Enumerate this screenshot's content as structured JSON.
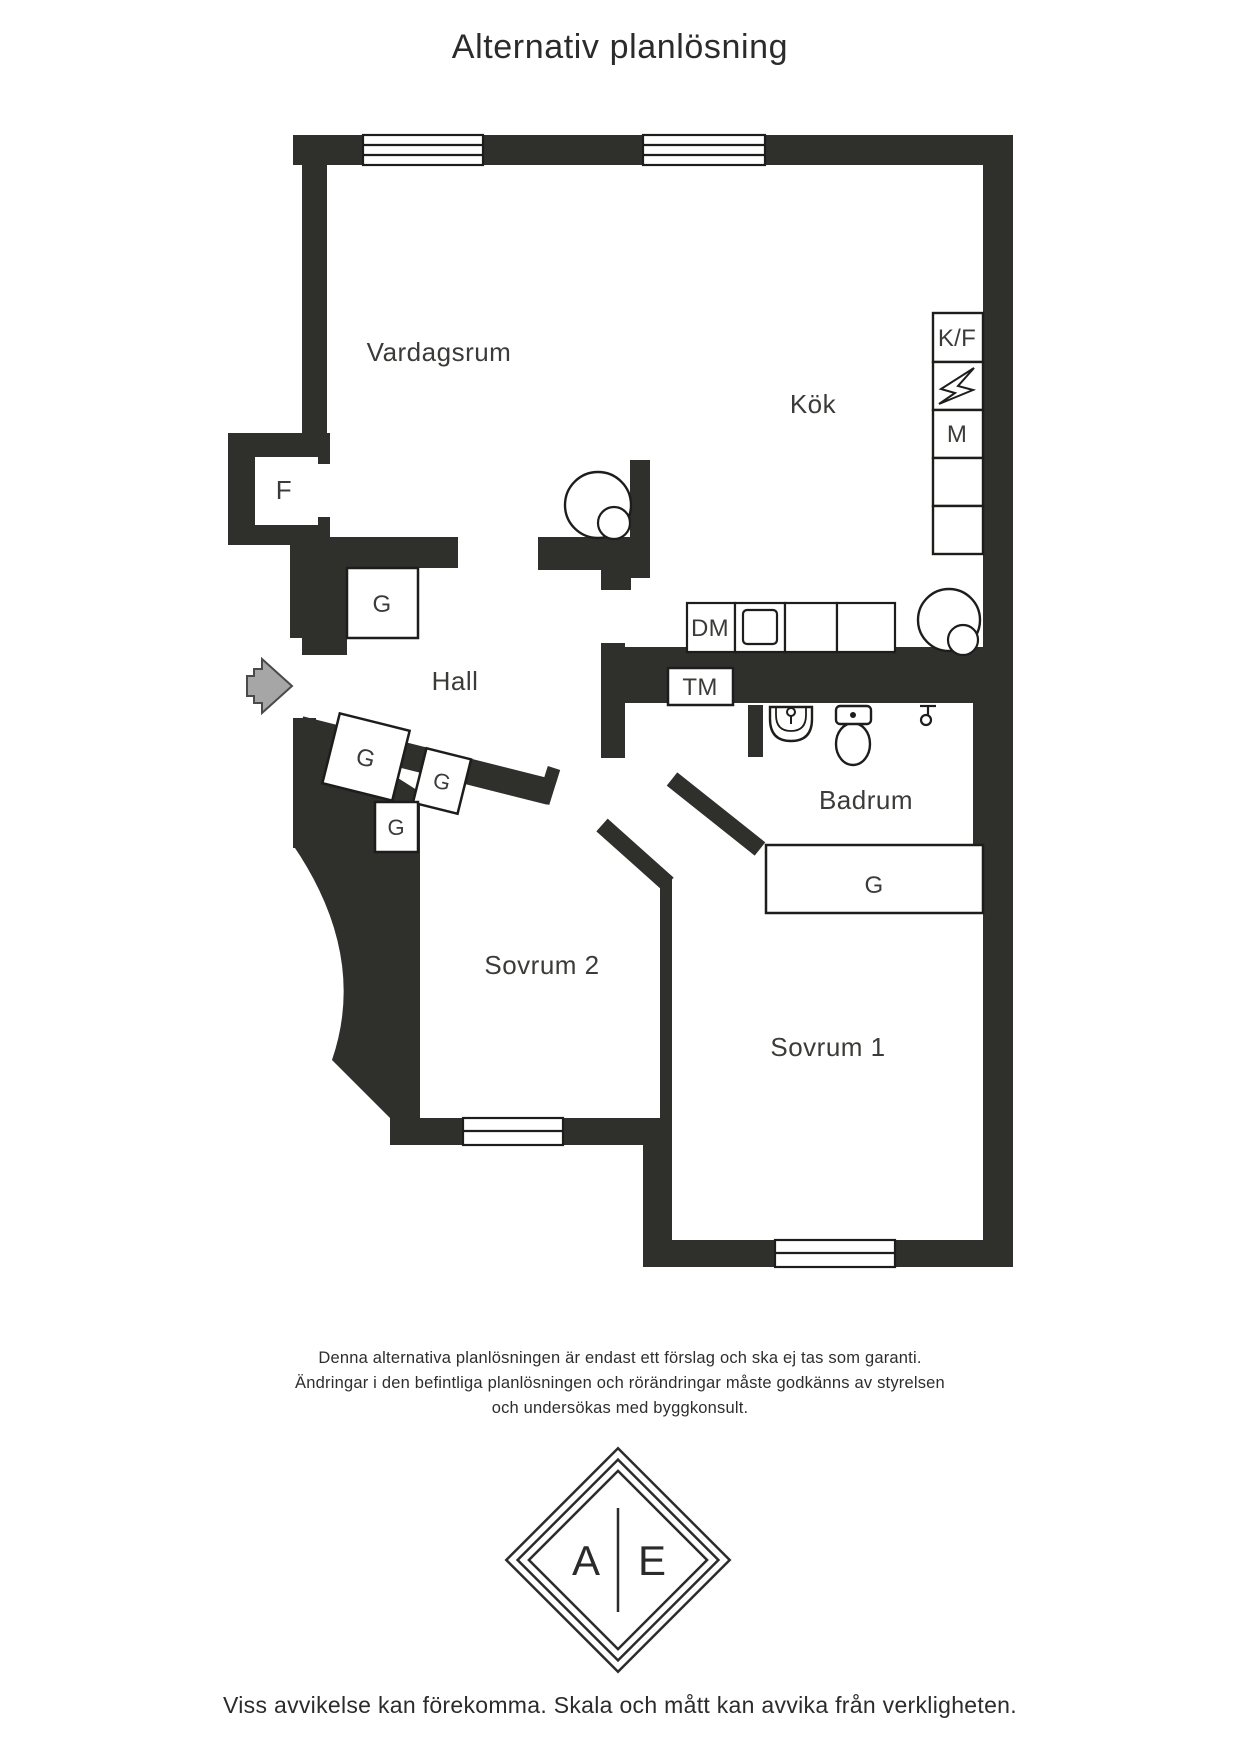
{
  "title": "Alternativ planlösning",
  "floorplan": {
    "rooms": [
      {
        "name": "Vardagsrum"
      },
      {
        "name": "Kök"
      },
      {
        "name": "Hall"
      },
      {
        "name": "Badrum"
      },
      {
        "name": "Sovrum 2"
      },
      {
        "name": "Sovrum 1"
      }
    ],
    "labels": {
      "fridge_freezer": "K/F",
      "microwave": "M",
      "dishwasher": "DM",
      "washing_machine": "TM",
      "closet_f": "F",
      "wardrobe": "G"
    },
    "colors": {
      "wall": "#2f2f2c",
      "line": "#1d1d1b",
      "text": "#3b3b39",
      "entry_arrow": "#a6a6a6"
    }
  },
  "disclaimer": [
    "Denna alternativa planlösningen är endast ett förslag och ska ej tas som garanti.",
    "Ändringar i den befintliga planlösningen och rörändringar måste godkänns av styrelsen",
    "och undersökas med byggkonsult."
  ],
  "logo": {
    "left": "A",
    "right": "E"
  },
  "footer": "Viss avvikelse kan förekomma. Skala och mått kan avvika från verkligheten."
}
